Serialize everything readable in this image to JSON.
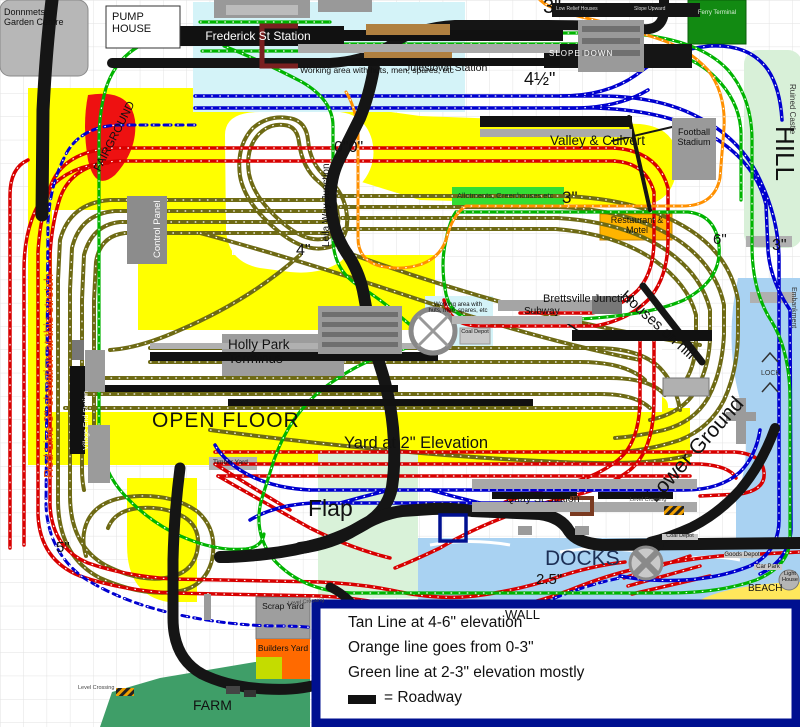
{
  "diagram_type": "model-railway-track-plan",
  "colors": {
    "tan_line": "#6e6a14",
    "red_line": "#d80000",
    "blue_line": "#0000cf",
    "green_line": "#00b400",
    "orange_line": "#ff9000",
    "roadway": "#151515",
    "open_floor": "#ffff00",
    "water": "#a9d2f2",
    "wall": "#001090"
  },
  "legend": {
    "line1": "Tan Line at 4-6\" elevation",
    "line2": "Orange line goes from 0-3\"",
    "line3": "Green line at 2-3\" elevation mostly",
    "roadway_label": "= Roadway"
  },
  "labels": {
    "garden_centre": "Donnmets Garden Centre",
    "pump_house": "PUMP HOUSE",
    "working_area_top": "Working area with huts, men, spares, etc",
    "frederick": "Frederick St Station",
    "julestown": "Julestown Station",
    "top_elev": "3\"",
    "slope_down": "SLOPE DOWN",
    "low_relief": "Low Relief Houses",
    "slope_upward": "Slope Upward",
    "ferry": "Ferry Terminal",
    "four_half_elev": "4½\"",
    "ruined_castle": "Ruined Castle",
    "hill": "HILL",
    "right_elev": "3\"",
    "embankment": "Embankment",
    "lock": "LOCK",
    "valley_culvert": "Valley & Culvert",
    "football": "Football Stadium",
    "allotments": "Allotments, Greenhouses etc",
    "mid_elev": "3\"",
    "restaurant": "Restaurant & Motel",
    "six_elev": "6\"",
    "houses_on_hill": "Houses on hill",
    "brettsville": "Brettsville Junction",
    "subway": "Subway",
    "working_area_center": "Working area with huts, men, spares, etc",
    "coal_depot_center": "Coal Depot",
    "leila": "Leila Way Junction",
    "zero_elev": "0\"0\"",
    "four_elev": "4\"",
    "control_panel": "Control Panel",
    "fairground": "FAIRGROUND",
    "red_line_note": "Red Line 3\" elevation at this stretch",
    "village_end": "Village End Station",
    "holly_park": "Holly Park Terminus",
    "open_floor": "OPEN FLOOR",
    "yard_elev": "Yard at 2\" Elevation",
    "timber_yard": "Timber Yard",
    "flap": "Flap",
    "quay": "Quay St Station",
    "lower_ground": "Lower Ground",
    "level_crossing_a": "Level Crossing",
    "level_crossing_b": "Level Crossing",
    "level_crossing_c": "Level Crossing",
    "docks": "DOCKS",
    "dock_elev": "2.5\"",
    "coal_depot": "Coal Depot",
    "goods_depot": "Goods Depot",
    "car_park": "Car Park",
    "light_house": "Light House",
    "beach": "BEACH",
    "wall": "WALL",
    "five_elev": "5\"",
    "farm": "FARM",
    "scrap_yard": "Scrap Yard",
    "builders_yard": "Builders Yard"
  }
}
